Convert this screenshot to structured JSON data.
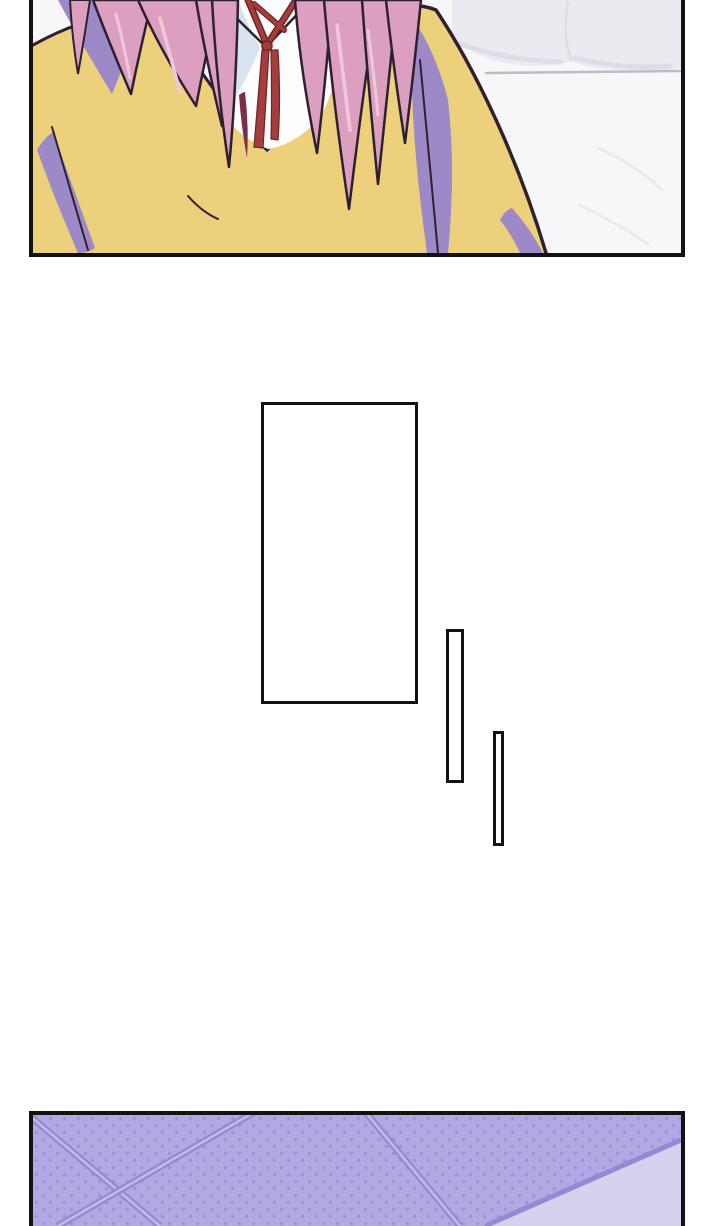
{
  "page": {
    "kind": "webtoon comic strip segment",
    "background": "#ffffff"
  },
  "colors": {
    "paper_white": "#ffffff",
    "panel_border": "#121212",
    "room_bg": "#f7f7fa",
    "pillow": "#eaeaf0",
    "pillow_shade": "#dcdde6",
    "bed_line": "#bcbdc7",
    "sheet_crease": "#e9e9f0",
    "sweater_yellow": "#ecd07c",
    "shadow_purple": "#9d88c8",
    "outline_dark": "#2d2130",
    "hair_pink": "#dd9fc0",
    "hair_highlight": "#efc7db",
    "hair_dark_strand": "#7a2f47",
    "shirt_white": "#fdfdff",
    "shirt_shade": "#d9e2ef",
    "tie_red": "#a63d3d",
    "tie_dark": "#6e2525",
    "floor_base": "#b3a7e4",
    "floor_dot": "#a092d8",
    "floor_line": "#9688d3",
    "floor_line_light": "#c3b9ec",
    "floor_light_area": "#d7d1ef",
    "box_fill": "#ffffff"
  },
  "panels": [
    {
      "name": "top-art-panel",
      "alt": "Close-up of a character from the neck down: long pink hair strands falling over a yellow sweater, white collared shirt with a dark red string tie, purple fold shadows, light gray bed and pillows in the background"
    },
    {
      "name": "bottom-art-panel",
      "alt": "Purple tiled floor seen at an angle, dotted texture with diagonal grout lines and a lighter plain area in the lower right corner"
    }
  ],
  "speech_boxes": [
    {
      "name": "tall-empty-box",
      "text": ""
    },
    {
      "name": "narrow-empty-box-1",
      "text": ""
    },
    {
      "name": "narrow-empty-box-2",
      "text": ""
    }
  ]
}
